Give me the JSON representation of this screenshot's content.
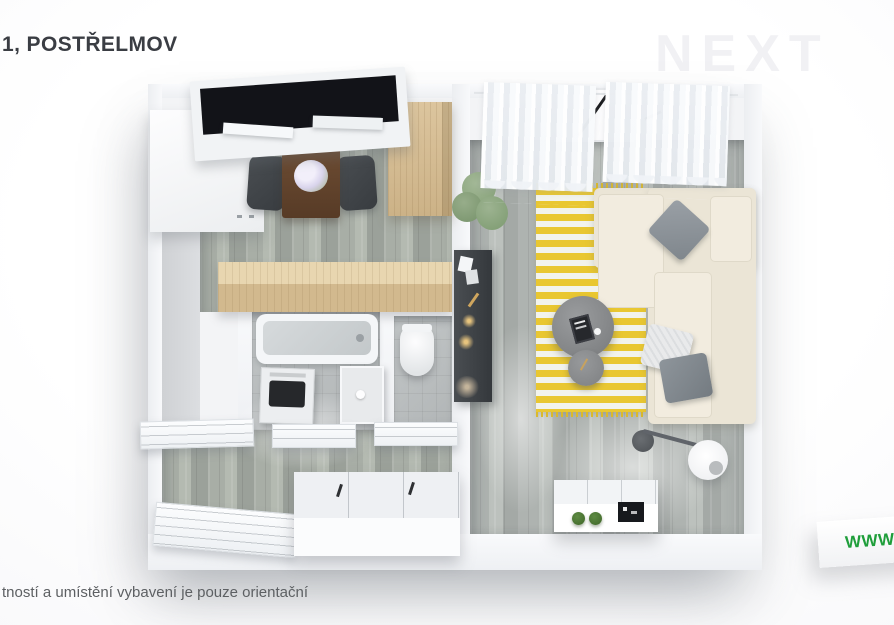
{
  "page": {
    "title": "1, POSTŘELMOV",
    "watermark": "NEXT",
    "disclaimer": "tností a umístění vybavení je pouze orientační",
    "ribbon_text": "WWW.N"
  },
  "colors": {
    "title_text": "#3a3d43",
    "disclaimer_text": "#5d6063",
    "ribbon_green": "#1f9e3b",
    "watermark_gray": "#f1f1f4",
    "background": "#fafafb",
    "wall_white": "#f4f5f7",
    "floor_wood_gray_green": "#a8aea6",
    "floor_tile_gray": "#bcc0c1",
    "rug_yellow": "#e9c731",
    "sofa_cream": "#ebe5d6",
    "cabinet_oak": "#d4bb91",
    "furniture_dark_gray": "#3f4347",
    "dining_table_walnut": "#64462f",
    "plant_green": "#8fa883",
    "window_glass_black": "#131419"
  },
  "floorplan": {
    "rooms": [
      "kitchen-dining",
      "bathroom",
      "wc",
      "hallway",
      "living-room"
    ],
    "furniture": [
      "roof-window",
      "wardrobe",
      "dining-table",
      "dining-chairs",
      "flower-bouquet",
      "tall-cabinet",
      "kitchen-counter",
      "bathtub",
      "washing-machine",
      "shower-sink",
      "toilet",
      "interior-doors",
      "built-in-wardrobe",
      "curtains",
      "casement-window",
      "houseplant",
      "striped-rug",
      "corner-sofa",
      "throw-pillows",
      "coffee-table",
      "side-table",
      "tv-console",
      "arc-floor-lamp",
      "sideboard",
      "potted-plants",
      "wall-art"
    ]
  }
}
